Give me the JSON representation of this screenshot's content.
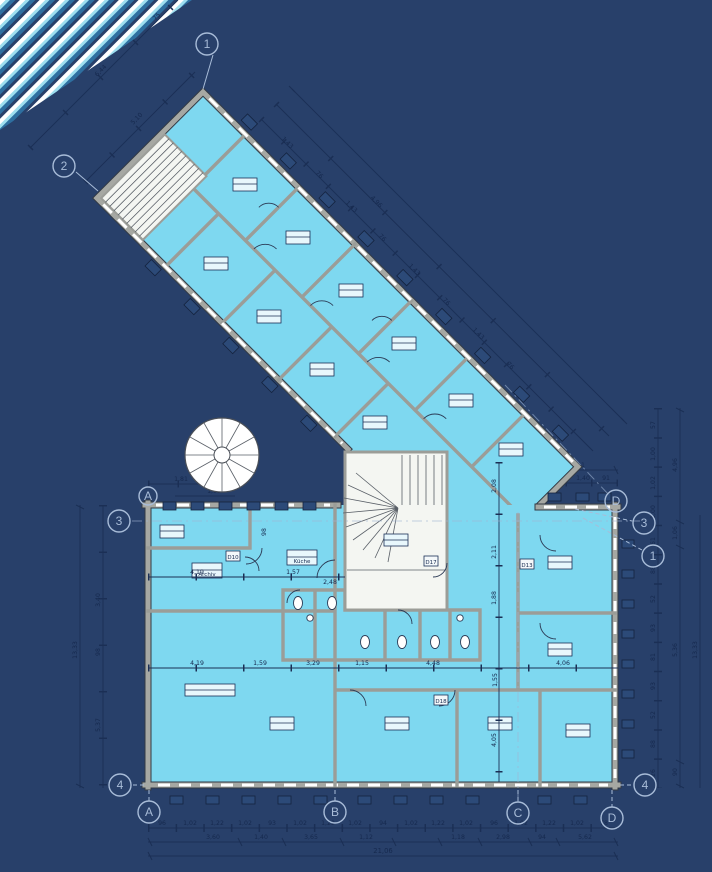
{
  "drawing": {
    "type": "architectural-floor-plan"
  },
  "colors": {
    "background": "#28406A",
    "room_fill": "#7ED8F0",
    "wall_gray": "#A6A8A3",
    "dimension_ink": "#16294E",
    "grid_marker": "#A8BCD8",
    "stair_white": "#F4F6F2",
    "stripe_cyan": "#9EDFF0",
    "stripe_blue": "#2E6FA0",
    "window_tag": "#2C4A78"
  },
  "markers": {
    "m1_top": "1",
    "m2_left": "2",
    "m3_left": "3",
    "mA_left": "A",
    "m4_bl": "4",
    "mA_bottom": "A",
    "mB_bottom": "B",
    "mC_bottom": "C",
    "mD_bottom": "D",
    "mD_right": "D",
    "m3_right": "3",
    "m1_right": "1",
    "m4_br": "4"
  },
  "labels": {
    "kitchen": "Küche",
    "archive": "Archiv"
  },
  "door_tags": [
    "D10",
    "D13",
    "D17",
    "D18"
  ],
  "dims": {
    "bottom_row1": [
      "96",
      "1,02",
      "1,22",
      "1,02",
      "93",
      "1,02",
      "1,22",
      "1,02",
      "94",
      "1,02",
      "1,22",
      "1,02",
      "96",
      "1,02",
      "1,22",
      "1,02",
      "78"
    ],
    "bottom_row2": [
      "3,60",
      "1,40",
      "3,65",
      "1,12",
      "1,18",
      "2,98",
      "94",
      "5,62"
    ],
    "bottom_total": "21,06",
    "left_inner": [
      "3,40",
      "98",
      "5,37"
    ],
    "left_total": "13,33",
    "left_top_row1": [
      "1,81",
      "1,12"
    ],
    "left_top_row2": [
      "1,03"
    ],
    "right_inner": [
      "57",
      "1,00",
      "1,02",
      "1,00",
      "61",
      "88",
      "52",
      "93",
      "81",
      "93",
      "52",
      "88",
      "26"
    ],
    "right_outer": [
      "4,96",
      "1,06",
      "5,36",
      "90"
    ],
    "right_total": "13,33",
    "top_right_a": "4,11",
    "top_right_b": [
      "1,02",
      "1,40",
      "91"
    ],
    "top_right_v": "2,88",
    "mid_h": [
      "4,19",
      "1,57",
      "2,48"
    ],
    "mid_v": "98",
    "corridor": [
      "4,19",
      "1,59",
      "3,29",
      "1,15",
      "4,48",
      "4,06"
    ],
    "corridor_v": "1,55",
    "interior_v": [
      "2,08",
      "2,11",
      "1,88",
      "4,05"
    ],
    "wing_nw": [
      "5,10",
      "6,44",
      "75"
    ],
    "wing_win_a": "1,43",
    "wing_win_b": "76",
    "wing_outer_total": "4,96"
  }
}
